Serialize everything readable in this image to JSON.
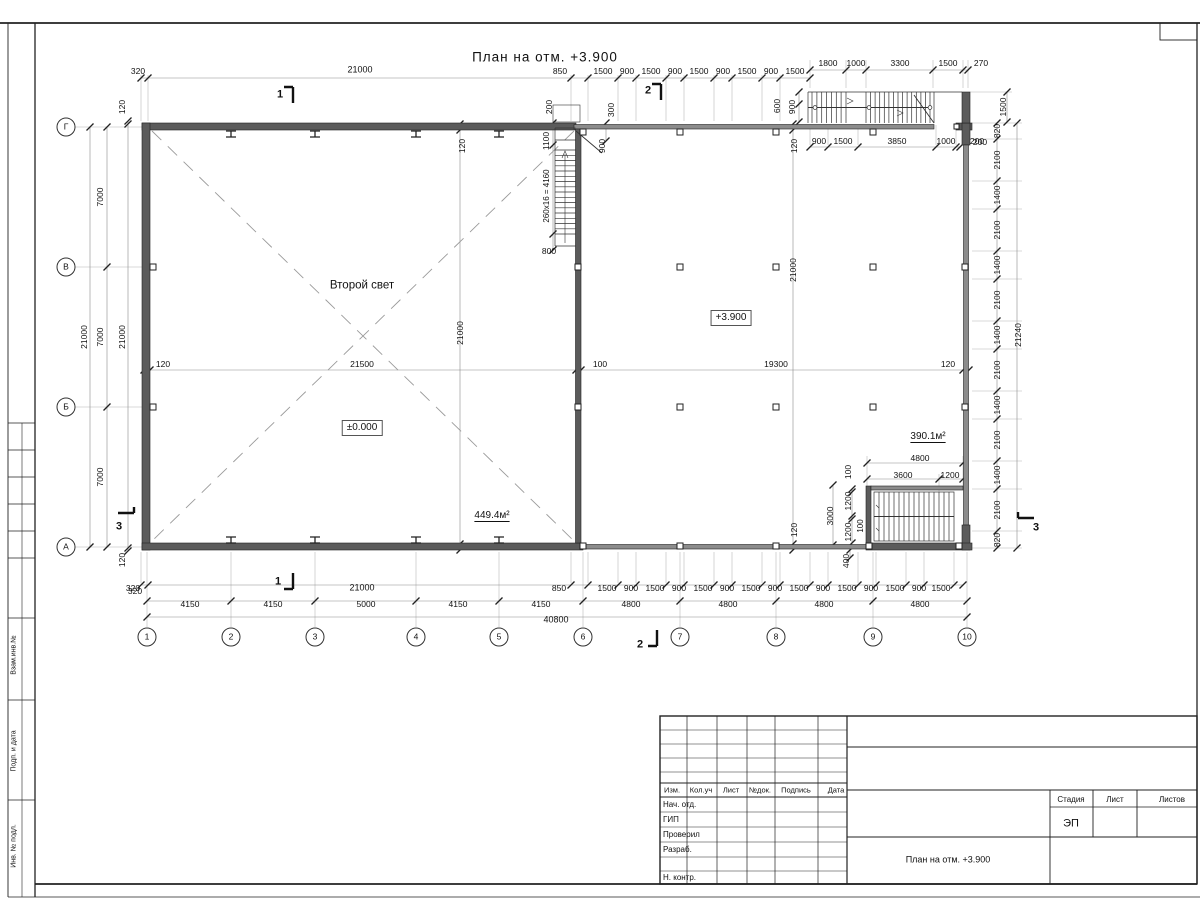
{
  "sheet": {
    "title": "План на отм. +3.900"
  },
  "stamp": {
    "stage_value": "ЭП",
    "doc_title": "План на отм. +3.900"
  },
  "labels": {
    "top_dims": [
      {
        "n": "dim-320",
        "t": "320",
        "x": 138,
        "y": 71
      },
      {
        "n": "dim-21000",
        "t": "21000",
        "x": 360,
        "y": 70,
        "fs": 9
      },
      {
        "n": "dim-850",
        "t": "850",
        "x": 560,
        "y": 71
      },
      {
        "n": "dim-1500",
        "t": "1500",
        "x": 603,
        "y": 71
      },
      {
        "n": "dim-900",
        "t": "900",
        "x": 627,
        "y": 71
      },
      {
        "n": "dim-1500",
        "t": "1500",
        "x": 651,
        "y": 71
      },
      {
        "n": "dim-900",
        "t": "900",
        "x": 675,
        "y": 71
      },
      {
        "n": "dim-1500",
        "t": "1500",
        "x": 699,
        "y": 71
      },
      {
        "n": "dim-900",
        "t": "900",
        "x": 723,
        "y": 71
      },
      {
        "n": "dim-1500",
        "t": "1500",
        "x": 747,
        "y": 71
      },
      {
        "n": "dim-900",
        "t": "900",
        "x": 771,
        "y": 71
      },
      {
        "n": "dim-1500",
        "t": "1500",
        "x": 795,
        "y": 71
      },
      {
        "n": "dim-1800",
        "t": "1800",
        "x": 828,
        "y": 63
      },
      {
        "n": "dim-1000",
        "t": "1000",
        "x": 856,
        "y": 63
      },
      {
        "n": "dim-3300",
        "t": "3300",
        "x": 900,
        "y": 63
      },
      {
        "n": "dim-1500",
        "t": "1500",
        "x": 948,
        "y": 63
      },
      {
        "n": "dim-270",
        "t": "270",
        "x": 981,
        "y": 63
      },
      {
        "n": "dim-900",
        "t": "900",
        "x": 819,
        "y": 141
      },
      {
        "n": "dim-1500",
        "t": "1500",
        "x": 843,
        "y": 141
      },
      {
        "n": "dim-3850",
        "t": "3850",
        "x": 897,
        "y": 141
      },
      {
        "n": "dim-1000",
        "t": "1000",
        "x": 946,
        "y": 141
      },
      {
        "n": "dim-200",
        "t": "200",
        "x": 977,
        "y": 141
      },
      {
        "n": "dim-200",
        "t": "200",
        "x": 549,
        "y": 107,
        "r": 1
      },
      {
        "n": "dim-300",
        "t": "300",
        "x": 611,
        "y": 110,
        "r": 1
      },
      {
        "n": "dim-600",
        "t": "600",
        "x": 777,
        "y": 106,
        "r": 1
      },
      {
        "n": "dim-900",
        "t": "900",
        "x": 792,
        "y": 107,
        "r": 1
      },
      {
        "n": "dim-1100",
        "t": "1100",
        "x": 546,
        "y": 141,
        "r": 1
      },
      {
        "n": "dim-900",
        "t": "900",
        "x": 602,
        "y": 146,
        "r": 1
      },
      {
        "n": "dim-120",
        "t": "120",
        "x": 462,
        "y": 146,
        "r": 1
      },
      {
        "n": "dim-120",
        "t": "120",
        "x": 794,
        "y": 146,
        "r": 1
      },
      {
        "n": "dim-800",
        "t": "800",
        "x": 549,
        "y": 251
      },
      {
        "n": "stair-formula",
        "t": "260x16 = 4160",
        "x": 547,
        "y": 196,
        "r": 1,
        "fs": 8
      },
      {
        "n": "dim-1500",
        "t": "1500",
        "x": 1003,
        "y": 107,
        "r": 1
      },
      {
        "n": "dim-200",
        "t": "200",
        "x": 980,
        "y": 142
      }
    ],
    "left_dims": [
      {
        "n": "dim-21000",
        "t": "21000",
        "x": 84,
        "y": 337,
        "r": 1
      },
      {
        "n": "dim-7000",
        "t": "7000",
        "x": 100,
        "y": 197,
        "r": 1
      },
      {
        "n": "dim-7000",
        "t": "7000",
        "x": 100,
        "y": 337,
        "r": 1
      },
      {
        "n": "dim-7000",
        "t": "7000",
        "x": 100,
        "y": 477,
        "r": 1
      },
      {
        "n": "dim-21000",
        "t": "21000",
        "x": 122,
        "y": 337,
        "r": 1
      },
      {
        "n": "dim-120",
        "t": "120",
        "x": 122,
        "y": 107,
        "r": 1
      },
      {
        "n": "dim-120",
        "t": "120",
        "x": 122,
        "y": 560,
        "r": 1
      },
      {
        "n": "dim-320",
        "t": "320",
        "x": 135,
        "y": 591
      }
    ],
    "right_dims": [
      {
        "n": "dim-820",
        "t": "820",
        "x": 997,
        "y": 131,
        "r": 1
      },
      {
        "n": "dim-2100",
        "t": "2100",
        "x": 997,
        "y": 160,
        "r": 1
      },
      {
        "n": "dim-1400",
        "t": "1400",
        "x": 997,
        "y": 195,
        "r": 1
      },
      {
        "n": "dim-2100",
        "t": "2100",
        "x": 997,
        "y": 230,
        "r": 1
      },
      {
        "n": "dim-1400",
        "t": "1400",
        "x": 997,
        "y": 265,
        "r": 1
      },
      {
        "n": "dim-2100",
        "t": "2100",
        "x": 997,
        "y": 300,
        "r": 1
      },
      {
        "n": "dim-1400",
        "t": "1400",
        "x": 997,
        "y": 335,
        "r": 1
      },
      {
        "n": "dim-2100",
        "t": "2100",
        "x": 997,
        "y": 370,
        "r": 1
      },
      {
        "n": "dim-1400",
        "t": "1400",
        "x": 997,
        "y": 405,
        "r": 1
      },
      {
        "n": "dim-2100",
        "t": "2100",
        "x": 997,
        "y": 440,
        "r": 1
      },
      {
        "n": "dim-1400",
        "t": "1400",
        "x": 997,
        "y": 475,
        "r": 1
      },
      {
        "n": "dim-2100",
        "t": "2100",
        "x": 997,
        "y": 510,
        "r": 1
      },
      {
        "n": "dim-820",
        "t": "820",
        "x": 997,
        "y": 540,
        "r": 1
      },
      {
        "n": "dim-21240",
        "t": "21240",
        "x": 1018,
        "y": 335,
        "r": 1
      }
    ],
    "interior": [
      {
        "n": "room-label-second-light",
        "t": "Второй свет",
        "x": 362,
        "y": 286,
        "fs": 11.5
      },
      {
        "n": "level-mark-zero",
        "t": "±0.000",
        "x": 362,
        "y": 428,
        "c": "box",
        "fs": 10
      },
      {
        "n": "area-449",
        "t": "449.4м²",
        "x": 492,
        "y": 516,
        "c": "und",
        "fs": 10
      },
      {
        "n": "level-mark-3900",
        "t": "+3.900",
        "x": 731,
        "y": 318,
        "c": "box",
        "fs": 10
      },
      {
        "n": "dim-120",
        "t": "120",
        "x": 163,
        "y": 364
      },
      {
        "n": "dim-21500",
        "t": "21500",
        "x": 362,
        "y": 364
      },
      {
        "n": "dim-100",
        "t": "100",
        "x": 600,
        "y": 364
      },
      {
        "n": "dim-19300",
        "t": "19300",
        "x": 776,
        "y": 364
      },
      {
        "n": "dim-120",
        "t": "120",
        "x": 948,
        "y": 364
      },
      {
        "n": "dim-21000",
        "t": "21000",
        "x": 460,
        "y": 333,
        "r": 1
      },
      {
        "n": "dim-21000",
        "t": "21000",
        "x": 793,
        "y": 270,
        "r": 1
      }
    ],
    "stair_br": [
      {
        "n": "area-390",
        "t": "390.1м²",
        "x": 928,
        "y": 437,
        "c": "und",
        "fs": 10
      },
      {
        "n": "dim-4800",
        "t": "4800",
        "x": 920,
        "y": 458
      },
      {
        "n": "dim-3600",
        "t": "3600",
        "x": 903,
        "y": 475
      },
      {
        "n": "dim-1200",
        "t": "1200",
        "x": 950,
        "y": 475
      },
      {
        "n": "dim-100",
        "t": "100",
        "x": 848,
        "y": 472,
        "r": 1
      },
      {
        "n": "dim-1200",
        "t": "1200",
        "x": 848,
        "y": 501,
        "r": 1
      },
      {
        "n": "dim-100",
        "t": "100",
        "x": 861,
        "y": 526,
        "r": 1,
        "fs": 8
      },
      {
        "n": "dim-1200",
        "t": "1200",
        "x": 848,
        "y": 532,
        "r": 1
      },
      {
        "n": "dim-3000",
        "t": "3000",
        "x": 830,
        "y": 516,
        "r": 1
      },
      {
        "n": "dim-400",
        "t": "400",
        "x": 846,
        "y": 561,
        "r": 1
      },
      {
        "n": "dim-120",
        "t": "120",
        "x": 794,
        "y": 530,
        "r": 1
      }
    ],
    "bottom_dims": [
      {
        "n": "dim-320",
        "t": "320",
        "x": 133,
        "y": 588
      },
      {
        "n": "dim-21000",
        "t": "21000",
        "x": 362,
        "y": 588,
        "fs": 9
      },
      {
        "n": "dim-850",
        "t": "850",
        "x": 559,
        "y": 588
      },
      {
        "n": "dim-1500",
        "t": "1500",
        "x": 607,
        "y": 588
      },
      {
        "n": "dim-900",
        "t": "900",
        "x": 631,
        "y": 588
      },
      {
        "n": "dim-1500",
        "t": "1500",
        "x": 655,
        "y": 588
      },
      {
        "n": "dim-900",
        "t": "900",
        "x": 679,
        "y": 588
      },
      {
        "n": "dim-1500",
        "t": "1500",
        "x": 703,
        "y": 588
      },
      {
        "n": "dim-900",
        "t": "900",
        "x": 727,
        "y": 588
      },
      {
        "n": "dim-1500",
        "t": "1500",
        "x": 751,
        "y": 588
      },
      {
        "n": "dim-900",
        "t": "900",
        "x": 775,
        "y": 588
      },
      {
        "n": "dim-1500",
        "t": "1500",
        "x": 799,
        "y": 588
      },
      {
        "n": "dim-900",
        "t": "900",
        "x": 823,
        "y": 588
      },
      {
        "n": "dim-1500",
        "t": "1500",
        "x": 847,
        "y": 588
      },
      {
        "n": "dim-900",
        "t": "900",
        "x": 871,
        "y": 588
      },
      {
        "n": "dim-1500",
        "t": "1500",
        "x": 895,
        "y": 588
      },
      {
        "n": "dim-900",
        "t": "900",
        "x": 919,
        "y": 588
      },
      {
        "n": "dim-1500",
        "t": "1500",
        "x": 941,
        "y": 588
      },
      {
        "n": "dim-4150",
        "t": "4150",
        "x": 190,
        "y": 604
      },
      {
        "n": "dim-4150",
        "t": "4150",
        "x": 273,
        "y": 604
      },
      {
        "n": "dim-5000",
        "t": "5000",
        "x": 366,
        "y": 604
      },
      {
        "n": "dim-4150",
        "t": "4150",
        "x": 458,
        "y": 604
      },
      {
        "n": "dim-4150",
        "t": "4150",
        "x": 541,
        "y": 604
      },
      {
        "n": "dim-4800",
        "t": "4800",
        "x": 631,
        "y": 604
      },
      {
        "n": "dim-4800",
        "t": "4800",
        "x": 728,
        "y": 604
      },
      {
        "n": "dim-4800",
        "t": "4800",
        "x": 824,
        "y": 604
      },
      {
        "n": "dim-4800",
        "t": "4800",
        "x": 920,
        "y": 604
      },
      {
        "n": "dim-40800",
        "t": "40800",
        "x": 556,
        "y": 620,
        "fs": 9
      }
    ],
    "axis_bubbles": [
      {
        "n": "axis-g",
        "t": "Г",
        "x": 66,
        "y": 127,
        "c": "bub"
      },
      {
        "n": "axis-v",
        "t": "В",
        "x": 66,
        "y": 267,
        "c": "bub"
      },
      {
        "n": "axis-b",
        "t": "Б",
        "x": 66,
        "y": 407,
        "c": "bub"
      },
      {
        "n": "axis-a",
        "t": "А",
        "x": 66,
        "y": 547,
        "c": "bub"
      },
      {
        "n": "axis-1",
        "t": "1",
        "x": 147,
        "y": 637,
        "c": "bub"
      },
      {
        "n": "axis-2",
        "t": "2",
        "x": 231,
        "y": 637,
        "c": "bub"
      },
      {
        "n": "axis-3",
        "t": "3",
        "x": 315,
        "y": 637,
        "c": "bub"
      },
      {
        "n": "axis-4",
        "t": "4",
        "x": 416,
        "y": 637,
        "c": "bub"
      },
      {
        "n": "axis-5",
        "t": "5",
        "x": 499,
        "y": 637,
        "c": "bub"
      },
      {
        "n": "axis-6",
        "t": "6",
        "x": 583,
        "y": 637,
        "c": "bub"
      },
      {
        "n": "axis-7",
        "t": "7",
        "x": 680,
        "y": 637,
        "c": "bub"
      },
      {
        "n": "axis-8",
        "t": "8",
        "x": 776,
        "y": 637,
        "c": "bub"
      },
      {
        "n": "axis-9",
        "t": "9",
        "x": 873,
        "y": 637,
        "c": "bub"
      },
      {
        "n": "axis-10",
        "t": "10",
        "x": 967,
        "y": 637,
        "c": "bub"
      }
    ],
    "section_marks": [
      {
        "n": "section-1-top",
        "t": "1",
        "x": 280,
        "y": 95,
        "c": "sec",
        "fs": 11
      },
      {
        "n": "section-1-bottom",
        "t": "1",
        "x": 278,
        "y": 582,
        "c": "sec",
        "fs": 11
      },
      {
        "n": "section-2-top",
        "t": "2",
        "x": 648,
        "y": 91,
        "c": "sec",
        "fs": 11
      },
      {
        "n": "section-2-bottom",
        "t": "2",
        "x": 640,
        "y": 645,
        "c": "sec",
        "fs": 11
      },
      {
        "n": "section-3-left",
        "t": "3",
        "x": 119,
        "y": 527,
        "c": "sec",
        "fs": 11
      },
      {
        "n": "section-3-right",
        "t": "3",
        "x": 1036,
        "y": 528,
        "c": "sec",
        "fs": 11
      }
    ],
    "title_block": [
      {
        "n": "tb-col-izm",
        "t": "Изм.",
        "x": 672,
        "y": 790,
        "fs": 7.5
      },
      {
        "n": "tb-col-koluch",
        "t": "Кол.уч",
        "x": 701,
        "y": 790,
        "fs": 7.5
      },
      {
        "n": "tb-col-list",
        "t": "Лист",
        "x": 731,
        "y": 790,
        "fs": 7.5
      },
      {
        "n": "tb-col-ndok",
        "t": "№док.",
        "x": 760,
        "y": 790,
        "fs": 7.5
      },
      {
        "n": "tb-col-podpis",
        "t": "Подпись",
        "x": 796,
        "y": 790,
        "fs": 7.5
      },
      {
        "n": "tb-col-data",
        "t": "Дата",
        "x": 836,
        "y": 790,
        "fs": 7.5
      },
      {
        "n": "tb-row-nach-otd",
        "t": "Нач. отд.",
        "x": 663,
        "y": 805,
        "c": "la",
        "fs": 8
      },
      {
        "n": "tb-row-gip",
        "t": "ГИП",
        "x": 663,
        "y": 820,
        "c": "la",
        "fs": 8
      },
      {
        "n": "tb-row-proveril",
        "t": "Проверил",
        "x": 663,
        "y": 835,
        "c": "la",
        "fs": 8
      },
      {
        "n": "tb-row-razrab",
        "t": "Разраб.",
        "x": 663,
        "y": 850,
        "c": "la",
        "fs": 8
      },
      {
        "n": "tb-row-nkontr",
        "t": "Н. контр.",
        "x": 663,
        "y": 878,
        "c": "la",
        "fs": 8
      },
      {
        "n": "tb-stage-header",
        "t": "Стадия",
        "x": 1071,
        "y": 800,
        "fs": 8
      },
      {
        "n": "tb-sheet-header",
        "t": "Лист",
        "x": 1115,
        "y": 800,
        "fs": 8
      },
      {
        "n": "tb-sheets-header",
        "t": "Листов",
        "x": 1172,
        "y": 800,
        "fs": 8
      },
      {
        "n": "tb-stage-value",
        "t": "ЭП",
        "x": 1071,
        "y": 824,
        "fs": 11
      },
      {
        "n": "tb-doc-title",
        "t": "План на отм. +3.900",
        "x": 948,
        "y": 860,
        "fs": 9
      }
    ],
    "side_stamp": [
      {
        "n": "side-vzam-inv",
        "t": "Взам.инв.№",
        "x": 14,
        "y": 655,
        "r": 1,
        "fs": 7
      },
      {
        "n": "side-podp-data",
        "t": "Подп. и дата",
        "x": 14,
        "y": 751,
        "r": 1,
        "fs": 7
      },
      {
        "n": "side-inv-podl",
        "t": "Инв. № подл.",
        "x": 14,
        "y": 846,
        "r": 1,
        "fs": 7
      }
    ]
  }
}
